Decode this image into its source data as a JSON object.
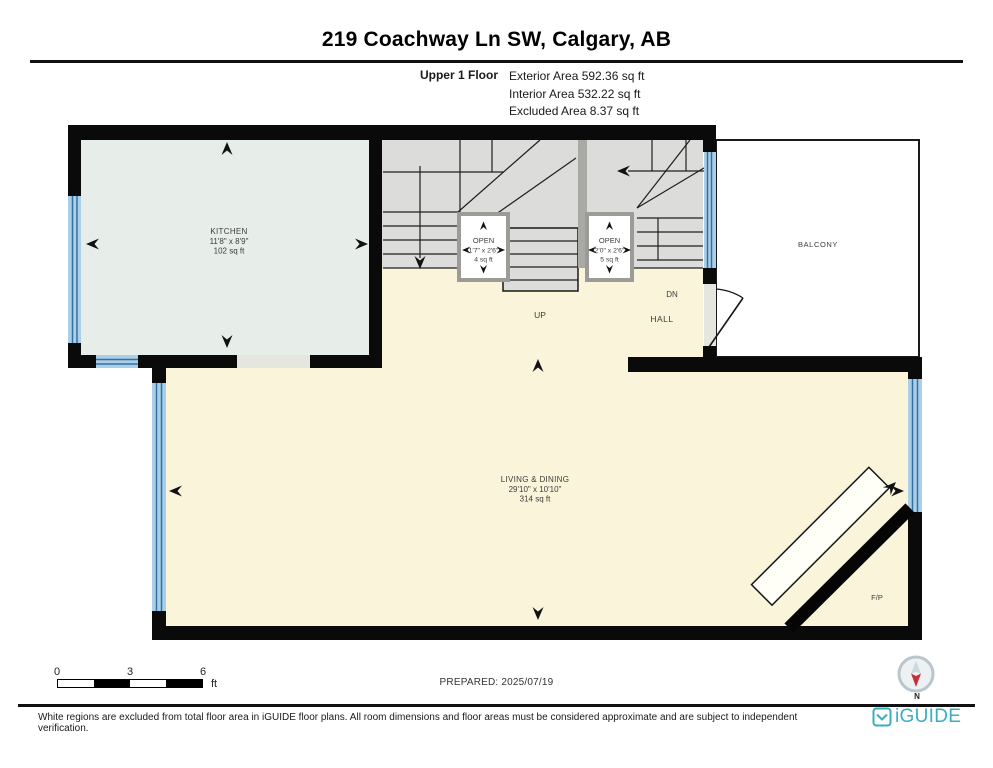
{
  "header": {
    "title": "219 Coachway Ln SW, Calgary, AB",
    "floor_label": "Upper 1 Floor",
    "stats": [
      "Exterior Area 592.36 sq ft",
      "Interior Area 532.22 sq ft",
      "Excluded Area 8.37 sq ft"
    ]
  },
  "rooms": {
    "kitchen": {
      "name": "KITCHEN",
      "dims": "11'8\" x 8'9\"",
      "area": "102 sq ft"
    },
    "living_dining": {
      "name": "LIVING & DINING",
      "dims": "29'10\" x 10'10\"",
      "area": "314 sq ft"
    },
    "balcony": {
      "name": "BALCONY"
    },
    "hall": {
      "name": "HALL"
    },
    "open_left": {
      "name": "OPEN",
      "dims": "1'7\" x 2'6\"",
      "area": "4 sq ft"
    },
    "open_right": {
      "name": "OPEN",
      "dims": "2'0\" x 2'6\"",
      "area": "5 sq ft"
    },
    "fireplace": {
      "name": "F/P"
    }
  },
  "stair_labels": {
    "up": "UP",
    "down": "DN"
  },
  "scale_bar": {
    "ticks": [
      "0",
      "3",
      "6"
    ],
    "unit": "ft"
  },
  "prepared_label": "PREPARED: 2025/07/19",
  "compass": {
    "north_label": "N"
  },
  "footer": {
    "disclaimer": "White regions are excluded from total floor area in iGUIDE floor plans. All room dimensions and floor areas must be considered approximate and are subject to independent verification.",
    "brand": "iGUIDE"
  },
  "colors": {
    "wall_black": "#0a0a0a",
    "window_blue": "#a9cfe9",
    "window_line_blue": "#35709f",
    "kitchen_fill": "#e7eee9",
    "floor_cream": "#faf4da",
    "stair_gray": "#dcdcda",
    "stair_wall_gray": "#a9a9a5",
    "balcony_white": "#ffffff",
    "brand_teal": "#3aaebe",
    "compass_red": "#c5303c"
  }
}
